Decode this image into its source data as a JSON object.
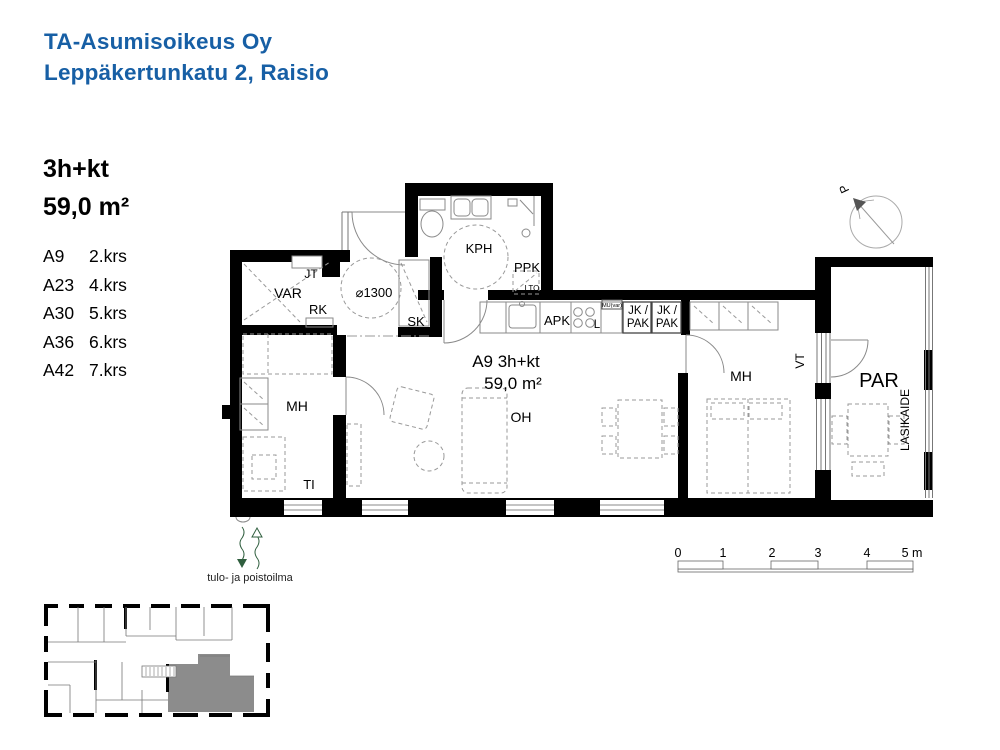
{
  "header": {
    "line1": "TA-Asumisoikeus Oy",
    "line2": "Leppäkertunkatu 2, Raisio"
  },
  "apartment": {
    "type": "3h+kt",
    "area": "59,0 m²",
    "units": [
      {
        "id": "A9",
        "floor": "2.krs"
      },
      {
        "id": "A23",
        "floor": "4.krs"
      },
      {
        "id": "A30",
        "floor": "5.krs"
      },
      {
        "id": "A36",
        "floor": "6.krs"
      },
      {
        "id": "A42",
        "floor": "7.krs"
      }
    ]
  },
  "plan": {
    "labels": {
      "jt": "JT",
      "var": "VAR",
      "rk": "RK",
      "diameter": "⌀1300",
      "sk": "SK",
      "kph": "KPH",
      "ppk": "PPK",
      "lto": "LTO",
      "apk": "APK",
      "stove": "L",
      "mu": "MU(var)",
      "jk_pak_top": "JK /",
      "jk_pak_bottom": "PAK",
      "unit_title": "A9 3h+kt",
      "unit_area": "59,0 m²",
      "oh": "OH",
      "mh": "MH",
      "ti": "TI",
      "vt": "VT",
      "par": "PAR",
      "lasikaide": "LASIKAIDE",
      "north": "P"
    }
  },
  "scale_bar": {
    "t0": "0",
    "t1": "1",
    "t2": "2",
    "t3": "3",
    "t4": "4",
    "t5": "5 m"
  },
  "ventilation_label": "tulo- ja poistoilma",
  "colors": {
    "header_blue": "#175fa5",
    "wall_black": "#000000",
    "line_gray": "#8a8a8a",
    "highlight_gray": "#8c8c8c",
    "vent_green": "#2f5e3e"
  }
}
